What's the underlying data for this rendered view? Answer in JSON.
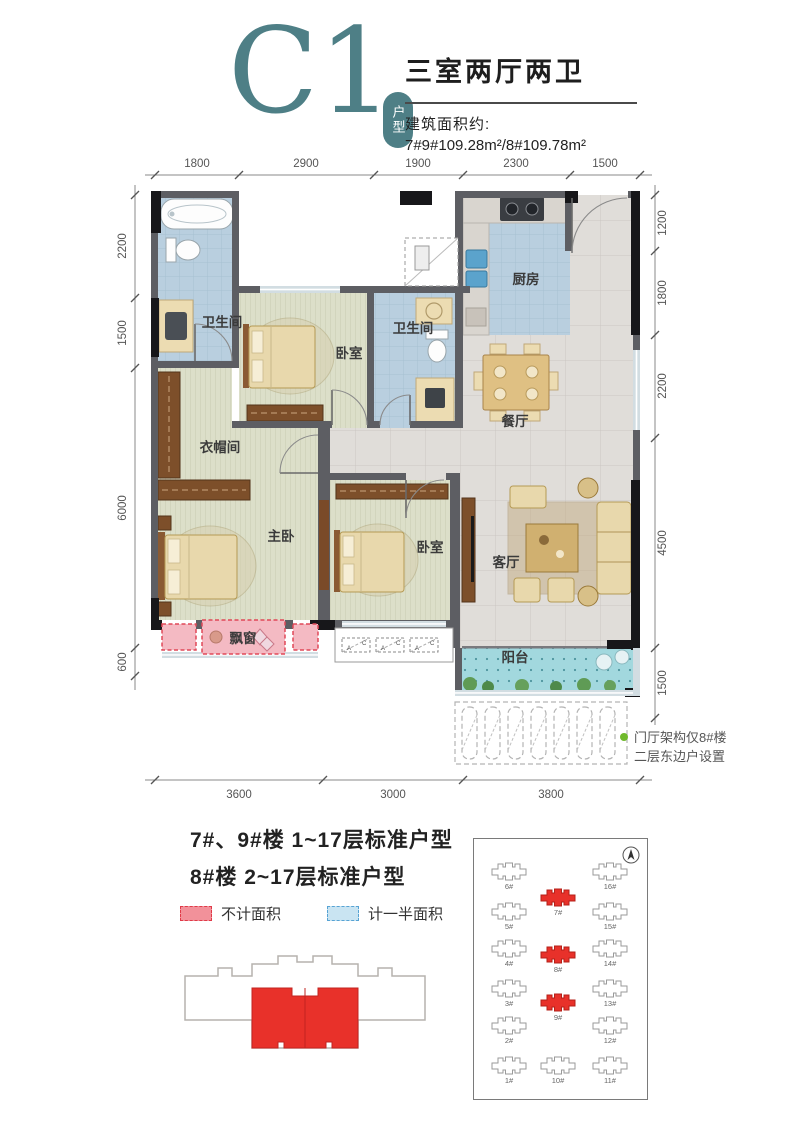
{
  "header": {
    "unit_code": "C1",
    "unit_badge": "户型",
    "title": "三室两厅两卫",
    "area_label": "建筑面积约:",
    "area_value": "7#9#109.28m²/8#109.78m²"
  },
  "plan": {
    "rooms": {
      "bath1": "卫生间",
      "bedroom_top": "卧室",
      "bath2": "卫生间",
      "kitchen": "厨房",
      "dining": "餐厅",
      "cloakroom": "衣帽间",
      "master": "主卧",
      "bedroom2": "卧室",
      "living": "客厅",
      "balcony": "阳台",
      "bay_window": "飘窗"
    },
    "ac_a": "A",
    "ac_c": "C",
    "note_line1": "门厅架构仅8#楼",
    "note_line2": "二层东边户设置"
  },
  "dims": {
    "top": [
      "1800",
      "2900",
      "1900",
      "2300",
      "1500"
    ],
    "left": [
      "2200",
      "1500",
      "6000",
      "600"
    ],
    "right": [
      "1200",
      "1800",
      "2200",
      "4500",
      "1500"
    ],
    "bottom": [
      "3600",
      "3000",
      "3800"
    ]
  },
  "floor_info": {
    "line1": "7#、9#楼 1~17层标准户型",
    "line2": "8#楼 2~17层标准户型"
  },
  "legend": {
    "excluded": "不计面积",
    "half": "计一半面积"
  },
  "site_plan": {
    "buildings": [
      {
        "label": "6#",
        "highlight": false
      },
      {
        "label": "16#",
        "highlight": false
      },
      {
        "label": "7#",
        "highlight": true
      },
      {
        "label": "5#",
        "highlight": false
      },
      {
        "label": "15#",
        "highlight": false
      },
      {
        "label": "4#",
        "highlight": false
      },
      {
        "label": "8#",
        "highlight": true
      },
      {
        "label": "14#",
        "highlight": false
      },
      {
        "label": "3#",
        "highlight": false
      },
      {
        "label": "9#",
        "highlight": true
      },
      {
        "label": "13#",
        "highlight": false
      },
      {
        "label": "2#",
        "highlight": false
      },
      {
        "label": "12#",
        "highlight": false
      },
      {
        "label": "1#",
        "highlight": false
      },
      {
        "label": "10#",
        "highlight": false
      },
      {
        "label": "11#",
        "highlight": false
      }
    ]
  },
  "colors": {
    "accent_teal": "#4e7f86",
    "highlight_red": "#e8312a",
    "legend_red_line": "#e03a48",
    "legend_blue_line": "#57a3d4"
  }
}
